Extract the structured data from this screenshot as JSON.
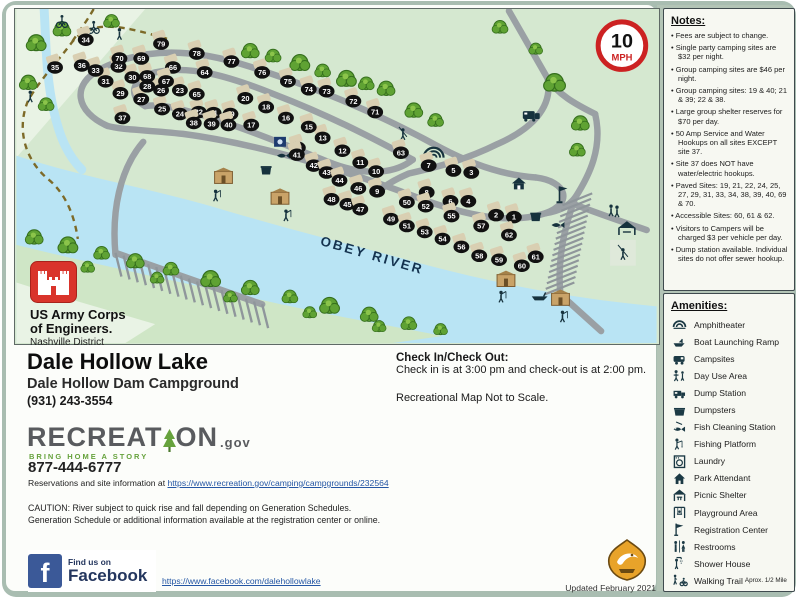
{
  "theme": {
    "frame": "#a9bdb1",
    "map_bg": "#d5e8d0",
    "river": "#b9e4f4",
    "bank": "#cfe6c6",
    "pale": "#e9f3e5",
    "road": "#9aa0a4",
    "tree": "#5fa233",
    "tree_edge": "#356f1d",
    "tree_hi": "#8bc44a",
    "marker": "#111111",
    "pad": "#d9cfb2",
    "icon": "#16323d",
    "sign_red": "#cc2222",
    "gold": "#e8a32a",
    "fb_blue": "#3b5998",
    "rec_green": "#66a23c"
  },
  "map": {
    "speed": {
      "value": "10",
      "unit": "MPH"
    },
    "river_label": "OBEY RIVER",
    "roads": [
      "M497,2 L536,70",
      "M536,70 C546,86 564,96 584,106",
      "M536,70 C542,100 518,122 486,136 C452,153 422,160 396,166 C382,172 372,178 366,184",
      "M584,106 C592,140 578,168 564,190",
      "M564,190 C550,228 546,260 549,288",
      "M549,288 L590,325",
      "M560,196 C586,206 612,215 636,223",
      "M92,118 C60,104 54,76 86,60 C130,38 180,40 235,58 C310,82 370,108 428,140 C462,158 494,168 524,170",
      "M524,170 C556,174 562,196 534,206 C498,218 452,208 404,190 C336,164 244,136 168,126 C132,122 106,122 92,118",
      "M130,98 C112,88 116,70 140,64 C175,56 215,68 260,86 C312,106 356,128 400,152",
      "M400,152 C380,168 348,168 314,154 C264,134 200,108 160,100 C146,97 136,97 130,98",
      "M100,248 C96,204 104,162 128,134",
      "M100,246 L248,298",
      "M534,206 C548,204 558,198 564,190"
    ],
    "trail": [
      "M152,30 C110,18 75,8 55,35 C40,55 25,70 12,92 C0,120 8,150 30,170 C48,184 58,205 62,232",
      "M78,0 C70,14 62,24 55,35"
    ],
    "stream": "M28,0 C30,36 30,70 38,104 C44,130 52,148 66,162",
    "river_path": "M0,148 C60,168 130,180 200,200 C280,224 340,238 420,260 C490,278 560,292 646,300 L646,337 L0,337 Z",
    "bank_path": "M0,238 C80,258 160,274 240,292 C320,310 380,320 430,330 L380,337 L0,337 Z",
    "pale_wedge_top": "M0,0 L130,0 L0,150 Z",
    "pale_wedge_bottom": "M0,276 C50,292 100,306 140,318 L110,337 L0,337 Z",
    "left_parking": {
      "x1": 100,
      "y1": 246,
      "x2": 248,
      "y2": 298,
      "n": 18,
      "tx": 6,
      "ty": 24
    },
    "right_parking": {
      "x1": 566,
      "y1": 192,
      "x2": 548,
      "y2": 282,
      "n": 16,
      "lx": 15,
      "ly": 6
    },
    "trees": [
      [
        20,
        34,
        1
      ],
      [
        46,
        20,
        0.9
      ],
      [
        12,
        74,
        0.9
      ],
      [
        30,
        96,
        0.8
      ],
      [
        96,
        12,
        0.8
      ],
      [
        236,
        42,
        0.9
      ],
      [
        259,
        47,
        0.8
      ],
      [
        286,
        54,
        1
      ],
      [
        309,
        62,
        0.8
      ],
      [
        333,
        70,
        1
      ],
      [
        353,
        75,
        0.8
      ],
      [
        373,
        80,
        0.9
      ],
      [
        401,
        102,
        0.9
      ],
      [
        423,
        112,
        0.8
      ],
      [
        543,
        74,
        1.1
      ],
      [
        569,
        115,
        0.9
      ],
      [
        566,
        142,
        0.8
      ],
      [
        488,
        18,
        0.8
      ],
      [
        524,
        40,
        0.7
      ],
      [
        18,
        230,
        0.9
      ],
      [
        52,
        238,
        1
      ],
      [
        86,
        246,
        0.8
      ],
      [
        120,
        254,
        0.9
      ],
      [
        156,
        262,
        0.8
      ],
      [
        196,
        272,
        1
      ],
      [
        236,
        281,
        0.9
      ],
      [
        276,
        290,
        0.8
      ],
      [
        316,
        299,
        1
      ],
      [
        356,
        308,
        0.9
      ],
      [
        396,
        317,
        0.8
      ],
      [
        428,
        323,
        0.7
      ],
      [
        72,
        260,
        0.7
      ],
      [
        142,
        271,
        0.7
      ],
      [
        216,
        290,
        0.7
      ],
      [
        296,
        306,
        0.7
      ],
      [
        366,
        320,
        0.7
      ]
    ],
    "sites": [
      {
        "n": 1,
        "x": 502,
        "y": 210
      },
      {
        "n": 2,
        "x": 484,
        "y": 208
      },
      {
        "n": 3,
        "x": 459,
        "y": 165
      },
      {
        "n": 4,
        "x": 456,
        "y": 194
      },
      {
        "n": 5,
        "x": 441,
        "y": 163
      },
      {
        "n": 6,
        "x": 438,
        "y": 194
      },
      {
        "n": 7,
        "x": 416,
        "y": 158
      },
      {
        "n": 8,
        "x": 414,
        "y": 185
      },
      {
        "n": 9,
        "x": 364,
        "y": 184
      },
      {
        "n": 10,
        "x": 363,
        "y": 164
      },
      {
        "n": 11,
        "x": 347,
        "y": 155
      },
      {
        "n": 12,
        "x": 329,
        "y": 143
      },
      {
        "n": 13,
        "x": 309,
        "y": 130
      },
      {
        "n": 14,
        "x": 284,
        "y": 140
      },
      {
        "n": 15,
        "x": 295,
        "y": 119
      },
      {
        "n": 16,
        "x": 272,
        "y": 110
      },
      {
        "n": 17,
        "x": 237,
        "y": 117
      },
      {
        "n": 18,
        "x": 252,
        "y": 99
      },
      {
        "n": 19,
        "x": 216,
        "y": 106
      },
      {
        "n": 20,
        "x": 231,
        "y": 90
      },
      {
        "n": 21,
        "x": 199,
        "y": 105
      },
      {
        "n": 22,
        "x": 184,
        "y": 104
      },
      {
        "n": 23,
        "x": 165,
        "y": 82
      },
      {
        "n": 24,
        "x": 165,
        "y": 106
      },
      {
        "n": 25,
        "x": 147,
        "y": 101
      },
      {
        "n": 26,
        "x": 146,
        "y": 82
      },
      {
        "n": 27,
        "x": 126,
        "y": 91
      },
      {
        "n": 28,
        "x": 132,
        "y": 78
      },
      {
        "n": 29,
        "x": 105,
        "y": 85
      },
      {
        "n": 30,
        "x": 117,
        "y": 69
      },
      {
        "n": 31,
        "x": 90,
        "y": 73
      },
      {
        "n": 32,
        "x": 103,
        "y": 58
      },
      {
        "n": 33,
        "x": 80,
        "y": 62
      },
      {
        "n": 34,
        "x": 70,
        "y": 31
      },
      {
        "n": 35,
        "x": 39,
        "y": 59
      },
      {
        "n": 36,
        "x": 66,
        "y": 57
      },
      {
        "n": 37,
        "x": 107,
        "y": 110
      },
      {
        "n": 38,
        "x": 179,
        "y": 115
      },
      {
        "n": 39,
        "x": 197,
        "y": 116
      },
      {
        "n": 40,
        "x": 214,
        "y": 117
      },
      {
        "n": 41,
        "x": 283,
        "y": 147
      },
      {
        "n": 42,
        "x": 300,
        "y": 158
      },
      {
        "n": 43,
        "x": 313,
        "y": 165
      },
      {
        "n": 44,
        "x": 326,
        "y": 173
      },
      {
        "n": 45,
        "x": 334,
        "y": 197
      },
      {
        "n": 46,
        "x": 345,
        "y": 181
      },
      {
        "n": 47,
        "x": 347,
        "y": 202
      },
      {
        "n": 48,
        "x": 318,
        "y": 192
      },
      {
        "n": 49,
        "x": 378,
        "y": 212
      },
      {
        "n": 50,
        "x": 394,
        "y": 195
      },
      {
        "n": 51,
        "x": 394,
        "y": 219
      },
      {
        "n": 52,
        "x": 413,
        "y": 199
      },
      {
        "n": 53,
        "x": 412,
        "y": 225
      },
      {
        "n": 54,
        "x": 430,
        "y": 232
      },
      {
        "n": 55,
        "x": 439,
        "y": 209
      },
      {
        "n": 56,
        "x": 449,
        "y": 240
      },
      {
        "n": 57,
        "x": 469,
        "y": 219
      },
      {
        "n": 58,
        "x": 467,
        "y": 249
      },
      {
        "n": 59,
        "x": 487,
        "y": 253
      },
      {
        "n": 60,
        "x": 510,
        "y": 259
      },
      {
        "n": 61,
        "x": 524,
        "y": 250
      },
      {
        "n": 62,
        "x": 497,
        "y": 228
      },
      {
        "n": 63,
        "x": 388,
        "y": 145
      },
      {
        "n": 64,
        "x": 190,
        "y": 64
      },
      {
        "n": 65,
        "x": 182,
        "y": 86
      },
      {
        "n": 66,
        "x": 158,
        "y": 59
      },
      {
        "n": 67,
        "x": 151,
        "y": 73
      },
      {
        "n": 68,
        "x": 132,
        "y": 68
      },
      {
        "n": 69,
        "x": 126,
        "y": 50
      },
      {
        "n": 70,
        "x": 104,
        "y": 50
      },
      {
        "n": 71,
        "x": 362,
        "y": 104
      },
      {
        "n": 72,
        "x": 340,
        "y": 93
      },
      {
        "n": 73,
        "x": 313,
        "y": 83
      },
      {
        "n": 74,
        "x": 295,
        "y": 81
      },
      {
        "n": 75,
        "x": 274,
        "y": 73
      },
      {
        "n": 76,
        "x": 248,
        "y": 64
      },
      {
        "n": 77,
        "x": 217,
        "y": 53
      },
      {
        "n": 78,
        "x": 182,
        "y": 45
      },
      {
        "n": 79,
        "x": 146,
        "y": 35
      }
    ],
    "icons": [
      {
        "t": "bike",
        "x": 46,
        "y": 14
      },
      {
        "t": "bike",
        "x": 78,
        "y": 20
      },
      {
        "t": "hiker",
        "x": 104,
        "y": 25
      },
      {
        "t": "hiker",
        "x": 14,
        "y": 88
      },
      {
        "t": "rv",
        "x": 519,
        "y": 108
      },
      {
        "t": "amphi",
        "x": 421,
        "y": 146
      },
      {
        "t": "swing",
        "x": 390,
        "y": 126
      },
      {
        "t": "house",
        "x": 507,
        "y": 176
      },
      {
        "t": "flag",
        "x": 548,
        "y": 188
      },
      {
        "t": "fishclean",
        "x": 545,
        "y": 218
      },
      {
        "t": "dayuse",
        "x": 603,
        "y": 203
      },
      {
        "t": "shelter",
        "x": 616,
        "y": 221
      },
      {
        "t": "playbox",
        "x": 612,
        "y": 246
      },
      {
        "t": "laundry",
        "x": 266,
        "y": 134
      },
      {
        "t": "fishclean",
        "x": 268,
        "y": 148
      },
      {
        "t": "dumpster",
        "x": 252,
        "y": 163
      },
      {
        "t": "dumpster",
        "x": 524,
        "y": 210
      },
      {
        "t": "restroom",
        "x": 209,
        "y": 170
      },
      {
        "t": "fisher",
        "x": 201,
        "y": 188
      },
      {
        "t": "restroom",
        "x": 266,
        "y": 191
      },
      {
        "t": "fisher",
        "x": 272,
        "y": 208
      },
      {
        "t": "restroom",
        "x": 494,
        "y": 274
      },
      {
        "t": "fisher",
        "x": 489,
        "y": 290
      },
      {
        "t": "restroom",
        "x": 549,
        "y": 293
      },
      {
        "t": "fisher",
        "x": 551,
        "y": 310
      },
      {
        "t": "boat",
        "x": 528,
        "y": 290
      }
    ]
  },
  "notes": {
    "title": "Notes:",
    "items": [
      "Fees are subject to change.",
      "Single party camping sites are $32 per night.",
      "Group camping sites are $46 per night.",
      "Group camping sites:  19 & 40; 21 & 39; 22 & 38.",
      "Large group shelter reserves for $70 per day.",
      "50 Amp Service and Water Hookups on all sites EXCEPT site 37.",
      "Site 37 does NOT have water/electric hookups.",
      "Paved Sites:  19, 21, 22, 24, 25, 27, 29, 31, 33, 34, 38, 39, 40, 69 & 70.",
      "Accessible Sites:  60, 61 & 62.",
      "Visitors to Campers will be charged $3 per vehicle per day.",
      "Dump station available. Individual sites do not offer sewer hookup."
    ]
  },
  "amenities": {
    "title": "Amenities:",
    "items": [
      {
        "icon": "amphitheater",
        "label": "Amphitheater"
      },
      {
        "icon": "boat-ramp",
        "label": "Boat Launching Ramp"
      },
      {
        "icon": "campsites",
        "label": "Campsites"
      },
      {
        "icon": "day-use",
        "label": "Day Use Area"
      },
      {
        "icon": "dump-station",
        "label": "Dump Station"
      },
      {
        "icon": "dumpsters",
        "label": "Dumpsters"
      },
      {
        "icon": "fish-cleaning",
        "label": "Fish Cleaning Station"
      },
      {
        "icon": "fishing-platform",
        "label": "Fishing Platform"
      },
      {
        "icon": "laundry",
        "label": "Laundry"
      },
      {
        "icon": "park-attendant",
        "label": "Park Attendant"
      },
      {
        "icon": "picnic-shelter",
        "label": "Picnic Shelter"
      },
      {
        "icon": "playground",
        "label": "Playground Area"
      },
      {
        "icon": "registration",
        "label": "Registration Center"
      },
      {
        "icon": "restrooms",
        "label": "Restrooms"
      },
      {
        "icon": "shower-house",
        "label": "Shower House"
      },
      {
        "icon": "walking-trail",
        "label": "Walking Trail",
        "suffix": "Aprox. 1/2 Mile"
      }
    ]
  },
  "usace": {
    "line1": "US Army Corps",
    "line2": "of Engineers.",
    "district": "Nashville District"
  },
  "park": {
    "title": "Dale Hollow Lake",
    "sub": "Dale Hollow Dam Campground",
    "phone": "(931) 243-3554"
  },
  "recreation": {
    "wordA": "RECREAT",
    "wordB": "ON",
    "tld": ".gov",
    "tagline": "BRING HOME A STORY",
    "phone": "877-444-6777",
    "res_prefix": "Reservations and site information at ",
    "res_url": "https://www.recreation.gov/camping/campgrounds/232564"
  },
  "checkin": {
    "title": "Check In/Check Out:",
    "body": "Check in is at 3:00 pm and check-out is at 2:00 pm.",
    "scale": "Recreational Map Not to Scale."
  },
  "caution": {
    "line1": "CAUTION: River subject to quick rise and fall depending on Generation Schedules.",
    "line2": "Generation Schedule or additional information available at the registration center or online."
  },
  "facebook": {
    "find": "Find us on",
    "name": "Facebook",
    "letter": "f",
    "url": "https://www.facebook.com/dalehollowlake"
  },
  "footer": {
    "updated": "Updated February 2021"
  }
}
